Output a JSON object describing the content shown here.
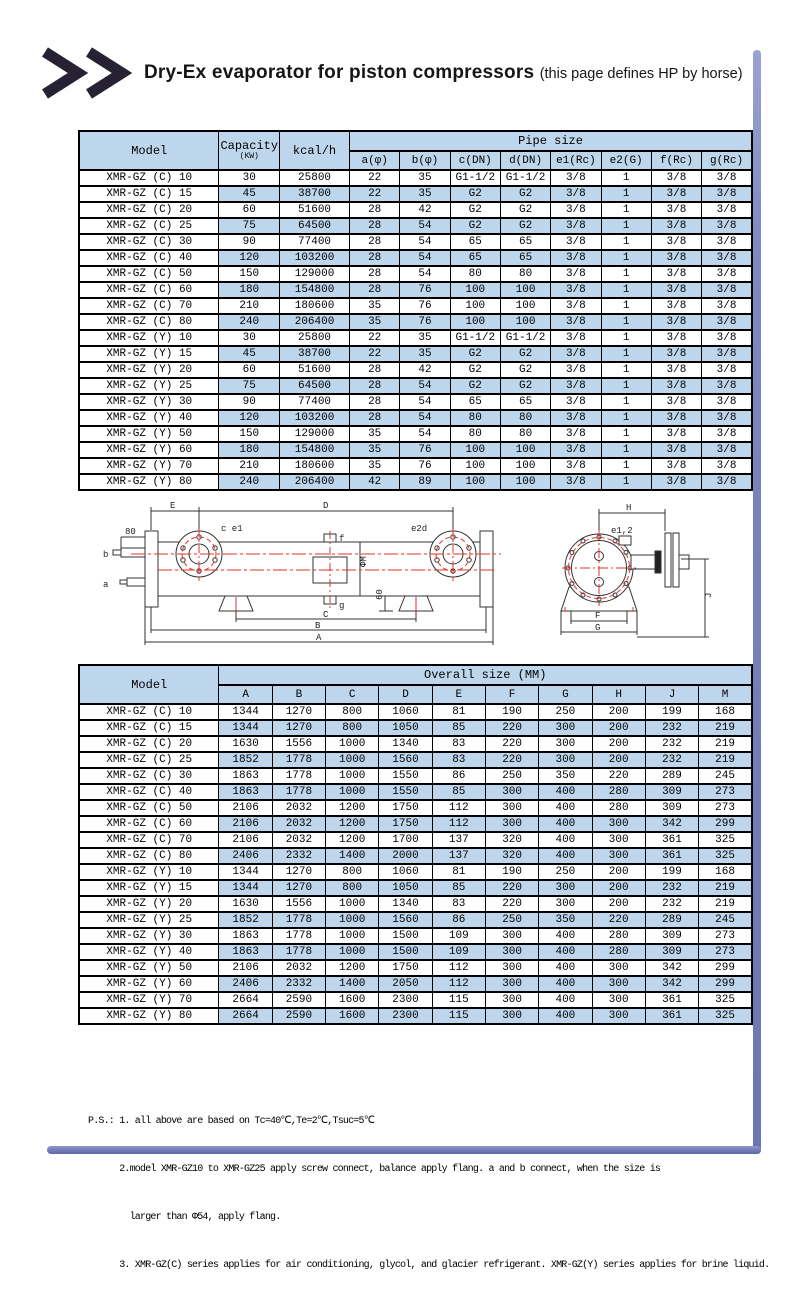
{
  "header": {
    "title": "Dry-Ex evaporator for piston compressors ",
    "suffix": "(this page defines HP by horse)"
  },
  "colors": {
    "row_blue": "#bdd6ec",
    "frame_blue": "#7d87c1",
    "drawing_red": "#e63229",
    "line_black": "#333333"
  },
  "pipe_table": {
    "headers": {
      "model": "Model",
      "capacity": "Capacity",
      "capacity_unit": "(KW)",
      "kcal": "kcal/h",
      "group": "Pipe size"
    },
    "columns": [
      "a(φ)",
      "b(φ)",
      "c(DN)",
      "d(DN)",
      "e1(Rc)",
      "e2(G)",
      "f(Rc)",
      "g(Rc)"
    ],
    "rows": [
      [
        "XMR-GZ (C) 10",
        "30",
        "25800",
        "22",
        "35",
        "G1-1/2",
        "G1-1/2",
        "3/8",
        "1",
        "3/8",
        "3/8"
      ],
      [
        "XMR-GZ (C) 15",
        "45",
        "38700",
        "22",
        "35",
        "G2",
        "G2",
        "3/8",
        "1",
        "3/8",
        "3/8"
      ],
      [
        "XMR-GZ (C) 20",
        "60",
        "51600",
        "28",
        "42",
        "G2",
        "G2",
        "3/8",
        "1",
        "3/8",
        "3/8"
      ],
      [
        "XMR-GZ (C) 25",
        "75",
        "64500",
        "28",
        "54",
        "G2",
        "G2",
        "3/8",
        "1",
        "3/8",
        "3/8"
      ],
      [
        "XMR-GZ (C) 30",
        "90",
        "77400",
        "28",
        "54",
        "65",
        "65",
        "3/8",
        "1",
        "3/8",
        "3/8"
      ],
      [
        "XMR-GZ (C) 40",
        "120",
        "103200",
        "28",
        "54",
        "65",
        "65",
        "3/8",
        "1",
        "3/8",
        "3/8"
      ],
      [
        "XMR-GZ (C) 50",
        "150",
        "129000",
        "28",
        "54",
        "80",
        "80",
        "3/8",
        "1",
        "3/8",
        "3/8"
      ],
      [
        "XMR-GZ (C) 60",
        "180",
        "154800",
        "28",
        "76",
        "100",
        "100",
        "3/8",
        "1",
        "3/8",
        "3/8"
      ],
      [
        "XMR-GZ (C) 70",
        "210",
        "180600",
        "35",
        "76",
        "100",
        "100",
        "3/8",
        "1",
        "3/8",
        "3/8"
      ],
      [
        "XMR-GZ (C) 80",
        "240",
        "206400",
        "35",
        "76",
        "100",
        "100",
        "3/8",
        "1",
        "3/8",
        "3/8"
      ],
      [
        "XMR-GZ (Y) 10",
        "30",
        "25800",
        "22",
        "35",
        "G1-1/2",
        "G1-1/2",
        "3/8",
        "1",
        "3/8",
        "3/8"
      ],
      [
        "XMR-GZ (Y) 15",
        "45",
        "38700",
        "22",
        "35",
        "G2",
        "G2",
        "3/8",
        "1",
        "3/8",
        "3/8"
      ],
      [
        "XMR-GZ (Y) 20",
        "60",
        "51600",
        "28",
        "42",
        "G2",
        "G2",
        "3/8",
        "1",
        "3/8",
        "3/8"
      ],
      [
        "XMR-GZ (Y) 25",
        "75",
        "64500",
        "28",
        "54",
        "G2",
        "G2",
        "3/8",
        "1",
        "3/8",
        "3/8"
      ],
      [
        "XMR-GZ (Y) 30",
        "90",
        "77400",
        "28",
        "54",
        "65",
        "65",
        "3/8",
        "1",
        "3/8",
        "3/8"
      ],
      [
        "XMR-GZ (Y) 40",
        "120",
        "103200",
        "28",
        "54",
        "80",
        "80",
        "3/8",
        "1",
        "3/8",
        "3/8"
      ],
      [
        "XMR-GZ (Y) 50",
        "150",
        "129000",
        "35",
        "54",
        "80",
        "80",
        "3/8",
        "1",
        "3/8",
        "3/8"
      ],
      [
        "XMR-GZ (Y) 60",
        "180",
        "154800",
        "35",
        "76",
        "100",
        "100",
        "3/8",
        "1",
        "3/8",
        "3/8"
      ],
      [
        "XMR-GZ (Y) 70",
        "210",
        "180600",
        "35",
        "76",
        "100",
        "100",
        "3/8",
        "1",
        "3/8",
        "3/8"
      ],
      [
        "XMR-GZ (Y) 80",
        "240",
        "206400",
        "42",
        "89",
        "100",
        "100",
        "3/8",
        "1",
        "3/8",
        "3/8"
      ]
    ]
  },
  "size_table": {
    "headers": {
      "model": "Model",
      "group": "Overall size (MM)"
    },
    "columns": [
      "A",
      "B",
      "C",
      "D",
      "E",
      "F",
      "G",
      "H",
      "J",
      "M"
    ],
    "rows": [
      [
        "XMR-GZ (C) 10",
        "1344",
        "1270",
        "800",
        "1060",
        "81",
        "190",
        "250",
        "200",
        "199",
        "168"
      ],
      [
        "XMR-GZ (C) 15",
        "1344",
        "1270",
        "800",
        "1050",
        "85",
        "220",
        "300",
        "200",
        "232",
        "219"
      ],
      [
        "XMR-GZ (C) 20",
        "1630",
        "1556",
        "1000",
        "1340",
        "83",
        "220",
        "300",
        "200",
        "232",
        "219"
      ],
      [
        "XMR-GZ (C) 25",
        "1852",
        "1778",
        "1000",
        "1560",
        "83",
        "220",
        "300",
        "200",
        "232",
        "219"
      ],
      [
        "XMR-GZ (C) 30",
        "1863",
        "1778",
        "1000",
        "1550",
        "86",
        "250",
        "350",
        "220",
        "289",
        "245"
      ],
      [
        "XMR-GZ (C) 40",
        "1863",
        "1778",
        "1000",
        "1550",
        "85",
        "300",
        "400",
        "280",
        "309",
        "273"
      ],
      [
        "XMR-GZ (C) 50",
        "2106",
        "2032",
        "1200",
        "1750",
        "112",
        "300",
        "400",
        "280",
        "309",
        "273"
      ],
      [
        "XMR-GZ (C) 60",
        "2106",
        "2032",
        "1200",
        "1750",
        "112",
        "300",
        "400",
        "300",
        "342",
        "299"
      ],
      [
        "XMR-GZ (C) 70",
        "2106",
        "2032",
        "1200",
        "1700",
        "137",
        "320",
        "400",
        "300",
        "361",
        "325"
      ],
      [
        "XMR-GZ (C) 80",
        "2406",
        "2332",
        "1400",
        "2000",
        "137",
        "320",
        "400",
        "300",
        "361",
        "325"
      ],
      [
        "XMR-GZ (Y) 10",
        "1344",
        "1270",
        "800",
        "1060",
        "81",
        "190",
        "250",
        "200",
        "199",
        "168"
      ],
      [
        "XMR-GZ (Y) 15",
        "1344",
        "1270",
        "800",
        "1050",
        "85",
        "220",
        "300",
        "200",
        "232",
        "219"
      ],
      [
        "XMR-GZ (Y) 20",
        "1630",
        "1556",
        "1000",
        "1340",
        "83",
        "220",
        "300",
        "200",
        "232",
        "219"
      ],
      [
        "XMR-GZ (Y) 25",
        "1852",
        "1778",
        "1000",
        "1560",
        "86",
        "250",
        "350",
        "220",
        "289",
        "245"
      ],
      [
        "XMR-GZ (Y) 30",
        "1863",
        "1778",
        "1000",
        "1500",
        "109",
        "300",
        "400",
        "280",
        "309",
        "273"
      ],
      [
        "XMR-GZ (Y) 40",
        "1863",
        "1778",
        "1000",
        "1500",
        "109",
        "300",
        "400",
        "280",
        "309",
        "273"
      ],
      [
        "XMR-GZ (Y) 50",
        "2106",
        "2032",
        "1200",
        "1750",
        "112",
        "300",
        "400",
        "300",
        "342",
        "299"
      ],
      [
        "XMR-GZ (Y) 60",
        "2406",
        "2332",
        "1400",
        "2050",
        "112",
        "300",
        "400",
        "300",
        "342",
        "299"
      ],
      [
        "XMR-GZ (Y) 70",
        "2664",
        "2590",
        "1600",
        "2300",
        "115",
        "300",
        "400",
        "300",
        "361",
        "325"
      ],
      [
        "XMR-GZ (Y) 80",
        "2664",
        "2590",
        "1600",
        "2300",
        "115",
        "300",
        "400",
        "300",
        "361",
        "325"
      ]
    ]
  },
  "drawing": {
    "dim_e": "E",
    "dim_d": "D",
    "dim_a": "A",
    "dim_b": "B",
    "dim_c": "C",
    "dim_80": "80",
    "dim_60": "60",
    "phi_m": "ΦM",
    "label_a": "a",
    "label_b": "b",
    "label_ce1": "c e1",
    "label_f": "f",
    "label_e2d": "e2d",
    "label_g": "g",
    "dim_h": "H",
    "dim_j": "J",
    "dim_f": "F",
    "dim_g": "G",
    "label_e12": "e1,2"
  },
  "notes": {
    "line1": "P.S.: 1. all above are based on Tc=40℃,Te=2℃,Tsuc=5℃",
    "line2": "      2.model XMR-GZ10 to XMR-GZ25 apply screw connect, balance apply flang. a and b connect, when the size is",
    "line3": "        larger than Φ54, apply flang.",
    "line4": "      3. XMR-GZ(C) series applies for air conditioning, glycol, and glacier refrigerant. XMR-GZ(Y) series applies for brine liquid."
  }
}
